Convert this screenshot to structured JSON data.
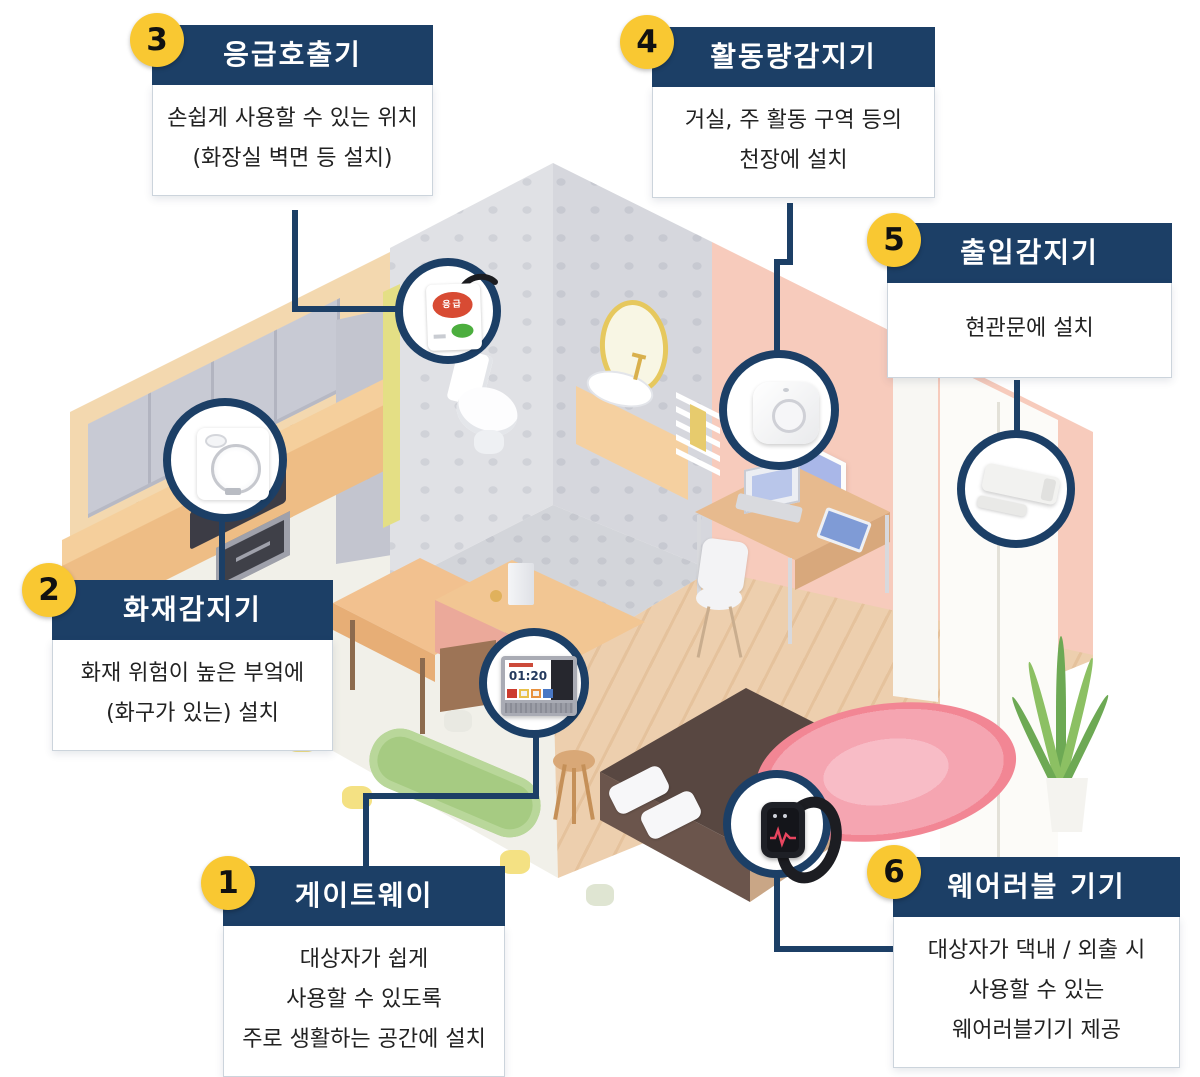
{
  "palette": {
    "navy": "#1c3f66",
    "badge_yellow": "#f9c832",
    "body_text": "#222222",
    "pink_wall": "#f7cbbc",
    "wood_floor": "#eccfae"
  },
  "callouts": [
    {
      "number": "1",
      "title": "게이트웨이",
      "lines": [
        "대상자가 쉽게",
        "사용할 수 있도록",
        "주로 생활하는 공간에 설치"
      ]
    },
    {
      "number": "2",
      "title": "화재감지기",
      "lines": [
        "화재 위험이 높은 부엌에",
        "(화구가 있는) 설치"
      ]
    },
    {
      "number": "3",
      "title": "응급호출기",
      "lines": [
        "손쉽게 사용할 수 있는 위치",
        "(화장실 벽면 등 설치)"
      ]
    },
    {
      "number": "4",
      "title": "활동량감지기",
      "lines": [
        "거실, 주 활동 구역 등의",
        "천장에 설치"
      ]
    },
    {
      "number": "5",
      "title": "출입감지기",
      "lines": [
        "현관문에 설치"
      ]
    },
    {
      "number": "6",
      "title": "웨어러블 기기",
      "lines": [
        "대상자가 댁내 / 외출 시",
        "사용할 수 있는",
        "웨어러블기기 제공"
      ]
    }
  ],
  "gateway_screen": {
    "time": "01:20"
  },
  "emergency_device": {
    "button_label": "응급"
  }
}
